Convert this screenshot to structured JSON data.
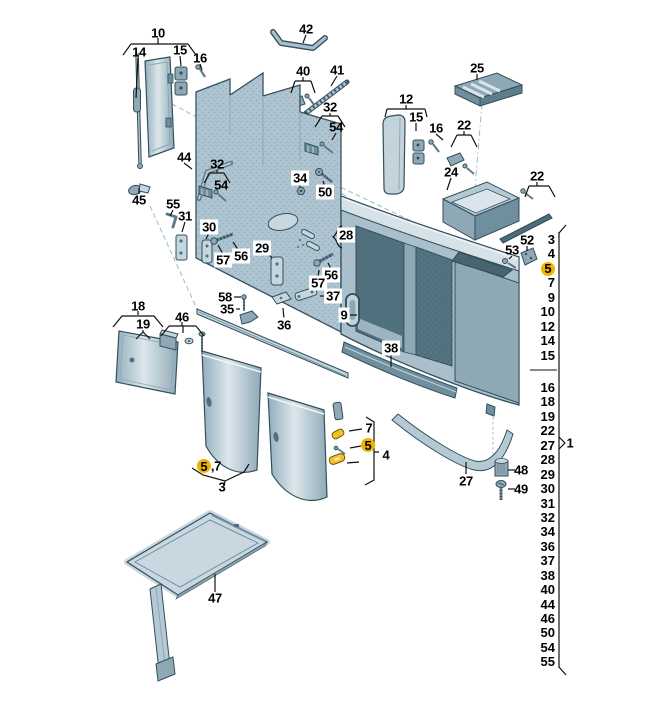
{
  "diagram": {
    "colors": {
      "highlight": "#F0B400",
      "part_fill": "#AEC4D0",
      "part_dark": "#6F8F9E",
      "outline": "#33505C"
    },
    "callouts": [
      {
        "label": "10",
        "x": 158,
        "y": 33
      },
      {
        "label": "14",
        "x": 139,
        "y": 52
      },
      {
        "label": "15",
        "x": 180,
        "y": 50
      },
      {
        "label": "16",
        "x": 200,
        "y": 58
      },
      {
        "label": "42",
        "x": 306,
        "y": 29
      },
      {
        "label": "40",
        "x": 303,
        "y": 71
      },
      {
        "label": "41",
        "x": 337,
        "y": 70
      },
      {
        "label": "25",
        "x": 477,
        "y": 68
      },
      {
        "label": "12",
        "x": 406,
        "y": 99
      },
      {
        "label": "15",
        "x": 416,
        "y": 117
      },
      {
        "label": "16",
        "x": 436,
        "y": 128
      },
      {
        "label": "22",
        "x": 464,
        "y": 125
      },
      {
        "label": "24",
        "x": 451,
        "y": 172
      },
      {
        "label": "22",
        "x": 537,
        "y": 176
      },
      {
        "label": "44",
        "x": 184,
        "y": 157
      },
      {
        "label": "32",
        "x": 217,
        "y": 164
      },
      {
        "label": "54",
        "x": 221,
        "y": 185
      },
      {
        "label": "32",
        "x": 330,
        "y": 107
      },
      {
        "label": "54",
        "x": 336,
        "y": 127
      },
      {
        "label": "45",
        "x": 139,
        "y": 200
      },
      {
        "label": "55",
        "x": 173,
        "y": 204
      },
      {
        "label": "31",
        "x": 185,
        "y": 216
      },
      {
        "label": "30",
        "x": 209,
        "y": 227,
        "box": true
      },
      {
        "label": "57",
        "x": 223,
        "y": 260,
        "box": true
      },
      {
        "label": "56",
        "x": 241,
        "y": 256,
        "box": true
      },
      {
        "label": "29",
        "x": 262,
        "y": 248,
        "box": true
      },
      {
        "label": "34",
        "x": 300,
        "y": 178,
        "box": true
      },
      {
        "label": "50",
        "x": 325,
        "y": 192,
        "box": true
      },
      {
        "label": "28",
        "x": 346,
        "y": 235,
        "box": true
      },
      {
        "label": "56",
        "x": 331,
        "y": 275,
        "box": true
      },
      {
        "label": "57",
        "x": 318,
        "y": 283,
        "box": true
      },
      {
        "label": "37",
        "x": 333,
        "y": 296,
        "box": true
      },
      {
        "label": "58",
        "x": 225,
        "y": 297,
        "box": true
      },
      {
        "label": "35",
        "x": 227,
        "y": 309,
        "box": true
      },
      {
        "label": "36",
        "x": 284,
        "y": 325,
        "box": true
      },
      {
        "label": "9",
        "x": 344,
        "y": 315,
        "box": true
      },
      {
        "label": "38",
        "x": 391,
        "y": 348,
        "box": true
      },
      {
        "label": "18",
        "x": 138,
        "y": 306
      },
      {
        "label": "19",
        "x": 143,
        "y": 324
      },
      {
        "label": "46",
        "x": 182,
        "y": 317
      },
      {
        "label": "52",
        "x": 527,
        "y": 240
      },
      {
        "label": "53",
        "x": 512,
        "y": 250
      },
      {
        "label": "7",
        "x": 369,
        "y": 428
      },
      {
        "label": "5",
        "x": 368,
        "y": 445,
        "hl": true
      },
      {
        "label": "4",
        "x": 386,
        "y": 455
      },
      {
        "label": "5",
        "suffix": ",7",
        "x": 209,
        "y": 466,
        "hl": true
      },
      {
        "label": "3",
        "x": 222,
        "y": 487
      },
      {
        "label": "27",
        "x": 466,
        "y": 481
      },
      {
        "label": "48",
        "x": 521,
        "y": 470
      },
      {
        "label": "49",
        "x": 521,
        "y": 489
      },
      {
        "label": "47",
        "x": 215,
        "y": 598
      },
      {
        "label": "1",
        "x": 570,
        "y": 443
      }
    ],
    "parts_list": {
      "upper": [
        "3",
        "4",
        "5",
        "7",
        "9",
        "10",
        "12",
        "14",
        "15"
      ],
      "lower": [
        "16",
        "18",
        "19",
        "22",
        "27",
        "28",
        "29",
        "30",
        "31",
        "32",
        "34",
        "36",
        "37",
        "38",
        "40",
        "44",
        "46",
        "50",
        "54",
        "55"
      ],
      "highlighted": [
        "5"
      ],
      "assembly_ref": "1"
    }
  }
}
